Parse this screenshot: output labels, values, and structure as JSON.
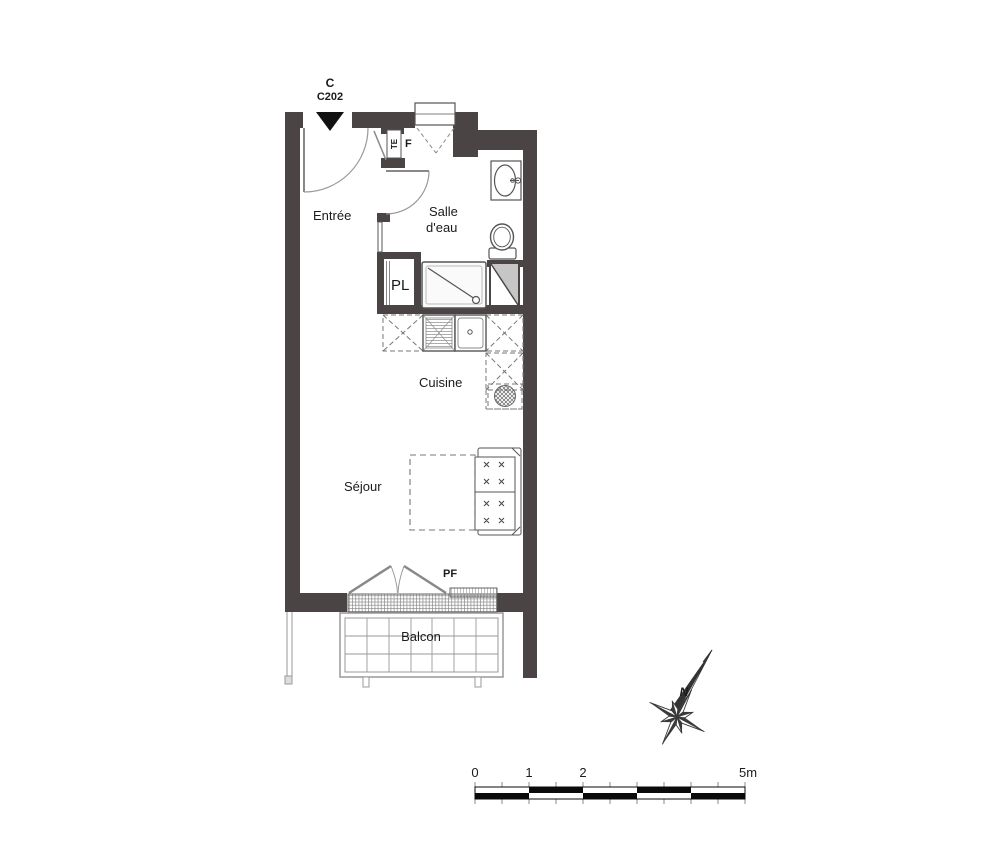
{
  "unit": {
    "building": "C",
    "number": "C202"
  },
  "rooms": {
    "entree": "Entrée",
    "salle_deau": [
      "Salle",
      "d'eau"
    ],
    "cuisine": "Cuisine",
    "sejour": "Séjour",
    "balcon": "Balcon"
  },
  "annotations": {
    "technical_box": "TE",
    "window": "F",
    "closet": "PL",
    "french_window": "PF"
  },
  "compass": {
    "north": "N"
  },
  "scale_bar": {
    "labels": [
      "0",
      "1",
      "2",
      "5m"
    ]
  },
  "colors": {
    "wall": "#4a4444",
    "fixture_line": "#555555",
    "light_line": "#999999",
    "dashed_line": "#777777",
    "duct_gray": "#c6c6c6",
    "scale_black": "#0a0a0a",
    "text": "#1a1a1a"
  }
}
